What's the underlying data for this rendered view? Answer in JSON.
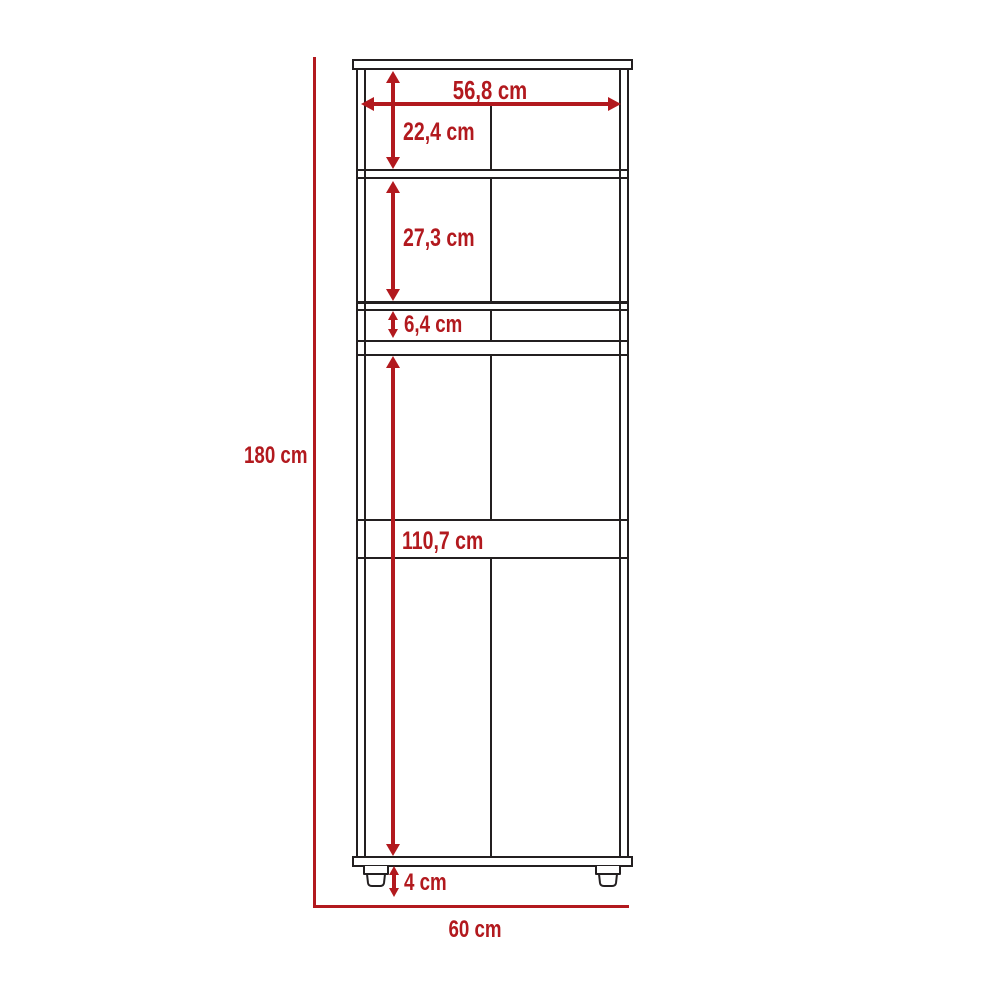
{
  "diagram": {
    "type": "furniture-dimension-drawing",
    "subject": "tall cabinet front elevation with shelves, drawer gap and feet",
    "unit": "cm"
  },
  "colors": {
    "dimension_red": "#b2191e",
    "outline_black": "#231f20",
    "background": "#ffffff"
  },
  "labels": {
    "inner_width": "56,8 cm",
    "top_niche_height": "22,4 cm",
    "second_niche_height": "27,3 cm",
    "drawer_gap_height": "6,4 cm",
    "lower_section_height": "110,7 cm",
    "total_height": "180 cm",
    "feet_height": "4 cm",
    "total_width": "60 cm"
  }
}
